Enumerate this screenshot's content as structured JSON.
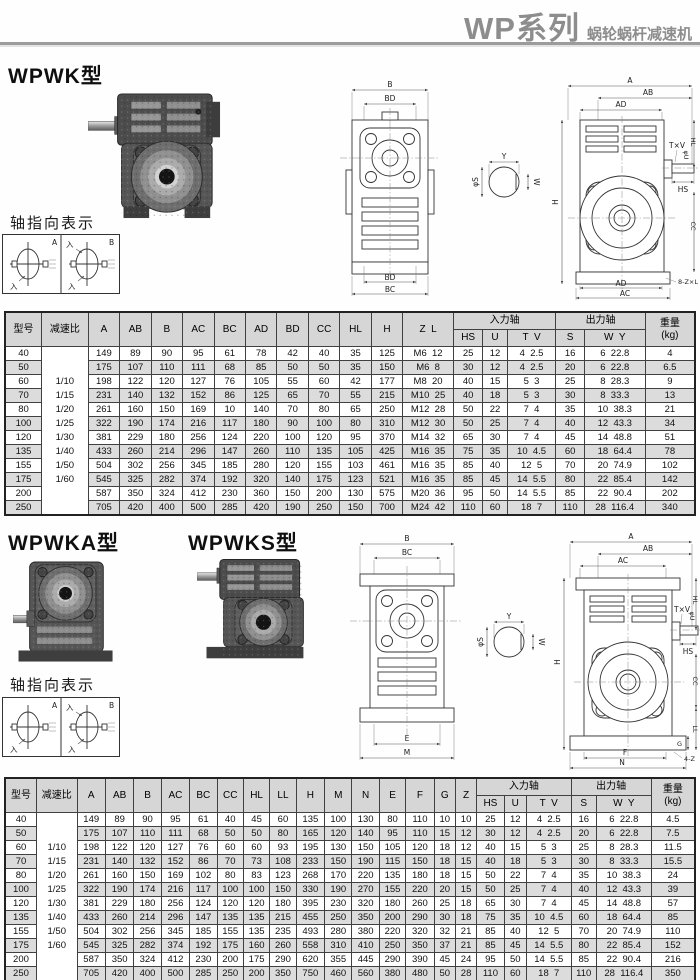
{
  "header": {
    "title": "WP系列",
    "subtitle": "蜗轮蜗杆减速机"
  },
  "sections": {
    "wpwk": {
      "heading": "WPWK型",
      "axis_label": "轴指向表示"
    },
    "wpwka": {
      "heading": "WPWKA型"
    },
    "wpwks": {
      "heading": "WPWKS型"
    },
    "axis_label2": "轴指向表示"
  },
  "axis_diagram": {
    "cell_a": "A",
    "cell_b": "B",
    "in_mark": "入"
  },
  "drawing1": {
    "labels": {
      "front_top_outer": "B",
      "front_top_inner": "BD",
      "front_bottom_inner": "BD",
      "front_bottom_outer": "BC",
      "shaft_top": "Y",
      "shaft_side": "W",
      "shaft_dia": "φS",
      "side_top1": "A",
      "side_top2": "AB",
      "side_top3": "AD",
      "height": "H",
      "key": "T×V",
      "dia": "φU",
      "hl": "HL",
      "hs": "HS",
      "cc": "CC",
      "side_bottom_inner": "AD",
      "side_bottom_outer": "AC",
      "note": "8-Z×L"
    }
  },
  "drawing2": {
    "labels": {
      "front_top_outer": "B",
      "front_top_inner": "BC",
      "front_bottom_inner": "E",
      "front_bottom_outer": "M",
      "shaft_top": "Y",
      "shaft_side": "W",
      "shaft_dia": "φS",
      "side_top1": "A",
      "side_top2": "AB",
      "side_top3": "AC",
      "height": "H",
      "key": "T×V",
      "dia": "φU",
      "hl": "HL",
      "hs": "HS",
      "cc": "CC",
      "ll": "LL",
      "g": "G",
      "side_bottom_inner": "F",
      "side_bottom_outer": "N",
      "note": "4-Z"
    }
  },
  "table1": {
    "top": [
      {
        "t": "型号",
        "rs": 2
      },
      {
        "t": "减速比",
        "rs": 2
      },
      {
        "t": "A",
        "rs": 2
      },
      {
        "t": "AB",
        "rs": 2
      },
      {
        "t": "B",
        "rs": 2
      },
      {
        "t": "AC",
        "rs": 2
      },
      {
        "t": "BC",
        "rs": 2
      },
      {
        "t": "AD",
        "rs": 2
      },
      {
        "t": "BD",
        "rs": 2
      },
      {
        "t": "CC",
        "rs": 2
      },
      {
        "t": "HL",
        "rs": 2
      },
      {
        "t": "H",
        "rs": 2
      },
      {
        "t": "Z  L",
        "rs": 2
      },
      {
        "t": "入力轴",
        "cs": 3
      },
      {
        "t": "出力轴",
        "cs": 2
      },
      {
        "t": "重量\n(kg)",
        "rs": 2
      }
    ],
    "sub": [
      "HS",
      "U",
      "T  V",
      "S",
      "W  Y"
    ],
    "widths": [
      36,
      46,
      31,
      31,
      31,
      31,
      31,
      31,
      31,
      31,
      31,
      31,
      50,
      29,
      24,
      48,
      28,
      60,
      49
    ],
    "ratios": [
      "1/10",
      "1/15",
      "1/20",
      "1/25",
      "1/30",
      "1/40",
      "1/50",
      "1/60"
    ],
    "rows": [
      [
        "40",
        "149",
        "89",
        "90",
        "95",
        "61",
        "78",
        "42",
        "40",
        "35",
        "125",
        "M6  12",
        "25",
        "12",
        "4  2.5",
        "16",
        "6  22.8",
        "4"
      ],
      [
        "50",
        "175",
        "107",
        "110",
        "111",
        "68",
        "85",
        "50",
        "50",
        "35",
        "150",
        "M6  8",
        "30",
        "12",
        "4  2.5",
        "20",
        "6  22.8",
        "6.5"
      ],
      [
        "60",
        "198",
        "122",
        "120",
        "127",
        "76",
        "105",
        "55",
        "60",
        "42",
        "177",
        "M8  20",
        "40",
        "15",
        "5  3",
        "25",
        "8  28.3",
        "9"
      ],
      [
        "70",
        "231",
        "140",
        "132",
        "152",
        "86",
        "125",
        "65",
        "70",
        "55",
        "215",
        "M10  25",
        "40",
        "18",
        "5  3",
        "30",
        "8  33.3",
        "13"
      ],
      [
        "80",
        "261",
        "160",
        "150",
        "169",
        "10",
        "140",
        "70",
        "80",
        "65",
        "250",
        "M12  28",
        "50",
        "22",
        "7  4",
        "35",
        "10  38.3",
        "21"
      ],
      [
        "100",
        "322",
        "190",
        "174",
        "216",
        "117",
        "180",
        "90",
        "100",
        "80",
        "310",
        "M12  30",
        "50",
        "25",
        "7  4",
        "40",
        "12  43.3",
        "34"
      ],
      [
        "120",
        "381",
        "229",
        "180",
        "256",
        "124",
        "220",
        "100",
        "120",
        "95",
        "370",
        "M14  32",
        "65",
        "30",
        "7  4",
        "45",
        "14  48.8",
        "51"
      ],
      [
        "135",
        "433",
        "260",
        "214",
        "296",
        "147",
        "260",
        "110",
        "135",
        "105",
        "425",
        "M16  35",
        "75",
        "35",
        "10  4.5",
        "60",
        "18  64.4",
        "78"
      ],
      [
        "155",
        "504",
        "302",
        "256",
        "345",
        "185",
        "280",
        "120",
        "155",
        "103",
        "461",
        "M16  35",
        "85",
        "40",
        "12  5",
        "70",
        "20  74.9",
        "102"
      ],
      [
        "175",
        "545",
        "325",
        "282",
        "374",
        "192",
        "320",
        "140",
        "175",
        "123",
        "521",
        "M16  35",
        "85",
        "45",
        "14  5.5",
        "80",
        "22  85.4",
        "142"
      ],
      [
        "200",
        "587",
        "350",
        "324",
        "412",
        "230",
        "360",
        "150",
        "200",
        "130",
        "575",
        "M20  36",
        "95",
        "50",
        "14  5.5",
        "85",
        "22  90.4",
        "202"
      ],
      [
        "250",
        "705",
        "420",
        "400",
        "500",
        "285",
        "420",
        "190",
        "250",
        "150",
        "700",
        "M24  42",
        "110",
        "60",
        "18  7",
        "110",
        "28  116.4",
        "340"
      ]
    ]
  },
  "table2": {
    "top": [
      {
        "t": "型号",
        "rs": 2
      },
      {
        "t": "减速比",
        "rs": 2
      },
      {
        "t": "A",
        "rs": 2
      },
      {
        "t": "AB",
        "rs": 2
      },
      {
        "t": "B",
        "rs": 2
      },
      {
        "t": "AC",
        "rs": 2
      },
      {
        "t": "BC",
        "rs": 2
      },
      {
        "t": "CC",
        "rs": 2
      },
      {
        "t": "HL",
        "rs": 2
      },
      {
        "t": "LL",
        "rs": 2
      },
      {
        "t": "H",
        "rs": 2
      },
      {
        "t": "M",
        "rs": 2
      },
      {
        "t": "N",
        "rs": 2
      },
      {
        "t": "E",
        "rs": 2
      },
      {
        "t": "F",
        "rs": 2
      },
      {
        "t": "G",
        "rs": 2
      },
      {
        "t": "Z",
        "rs": 2
      },
      {
        "t": "入力轴",
        "cs": 3
      },
      {
        "t": "出力轴",
        "cs": 2
      },
      {
        "t": "重量\n(kg)",
        "rs": 2
      }
    ],
    "sub": [
      "HS",
      "U",
      "T  V",
      "S",
      "W  Y"
    ],
    "widths": [
      31,
      40,
      28,
      28,
      27,
      28,
      27,
      26,
      26,
      26,
      28,
      27,
      27,
      26,
      28,
      21,
      21,
      27,
      22,
      44,
      25,
      54,
      43
    ],
    "ratios": [
      "1/10",
      "1/15",
      "1/20",
      "1/25",
      "1/30",
      "1/40",
      "1/50",
      "1/60"
    ],
    "rows": [
      [
        "40",
        "149",
        "89",
        "90",
        "95",
        "61",
        "40",
        "45",
        "60",
        "135",
        "100",
        "130",
        "80",
        "110",
        "10",
        "10",
        "25",
        "12",
        "4  2.5",
        "16",
        "6  22.8",
        "4.5"
      ],
      [
        "50",
        "175",
        "107",
        "110",
        "111",
        "68",
        "50",
        "50",
        "80",
        "165",
        "120",
        "140",
        "95",
        "110",
        "15",
        "12",
        "30",
        "12",
        "4  2.5",
        "20",
        "6  22.8",
        "7.5"
      ],
      [
        "60",
        "198",
        "122",
        "120",
        "127",
        "76",
        "60",
        "60",
        "93",
        "195",
        "130",
        "150",
        "105",
        "120",
        "18",
        "12",
        "40",
        "15",
        "5  3",
        "25",
        "8  28.3",
        "11.5"
      ],
      [
        "70",
        "231",
        "140",
        "132",
        "152",
        "86",
        "70",
        "73",
        "108",
        "233",
        "150",
        "190",
        "115",
        "150",
        "18",
        "15",
        "40",
        "18",
        "5  3",
        "30",
        "8  33.3",
        "15.5"
      ],
      [
        "80",
        "261",
        "160",
        "150",
        "169",
        "102",
        "80",
        "83",
        "123",
        "268",
        "170",
        "220",
        "135",
        "180",
        "18",
        "15",
        "50",
        "22",
        "7  4",
        "35",
        "10  38.3",
        "24"
      ],
      [
        "100",
        "322",
        "190",
        "174",
        "216",
        "117",
        "100",
        "100",
        "150",
        "330",
        "190",
        "270",
        "155",
        "220",
        "20",
        "15",
        "50",
        "25",
        "7  4",
        "40",
        "12  43.3",
        "39"
      ],
      [
        "120",
        "381",
        "229",
        "180",
        "256",
        "124",
        "120",
        "120",
        "180",
        "395",
        "230",
        "320",
        "180",
        "260",
        "25",
        "18",
        "65",
        "30",
        "7  4",
        "45",
        "14  48.8",
        "57"
      ],
      [
        "135",
        "433",
        "260",
        "214",
        "296",
        "147",
        "135",
        "135",
        "215",
        "455",
        "250",
        "350",
        "200",
        "290",
        "30",
        "18",
        "75",
        "35",
        "10  4.5",
        "60",
        "18  64.4",
        "85"
      ],
      [
        "155",
        "504",
        "302",
        "256",
        "345",
        "185",
        "155",
        "135",
        "235",
        "493",
        "280",
        "380",
        "220",
        "320",
        "32",
        "21",
        "85",
        "40",
        "12  5",
        "70",
        "20  74.9",
        "110"
      ],
      [
        "175",
        "545",
        "325",
        "282",
        "374",
        "192",
        "175",
        "160",
        "260",
        "558",
        "310",
        "410",
        "250",
        "350",
        "37",
        "21",
        "85",
        "45",
        "14  5.5",
        "80",
        "22  85.4",
        "152"
      ],
      [
        "200",
        "587",
        "350",
        "324",
        "412",
        "230",
        "200",
        "175",
        "290",
        "620",
        "355",
        "445",
        "290",
        "390",
        "45",
        "24",
        "95",
        "50",
        "14  5.5",
        "85",
        "22  90.4",
        "216"
      ],
      [
        "250",
        "705",
        "420",
        "400",
        "500",
        "285",
        "250",
        "200",
        "350",
        "750",
        "460",
        "560",
        "380",
        "480",
        "50",
        "28",
        "110",
        "60",
        "18  7",
        "110",
        "28  116.4",
        "350"
      ]
    ]
  }
}
